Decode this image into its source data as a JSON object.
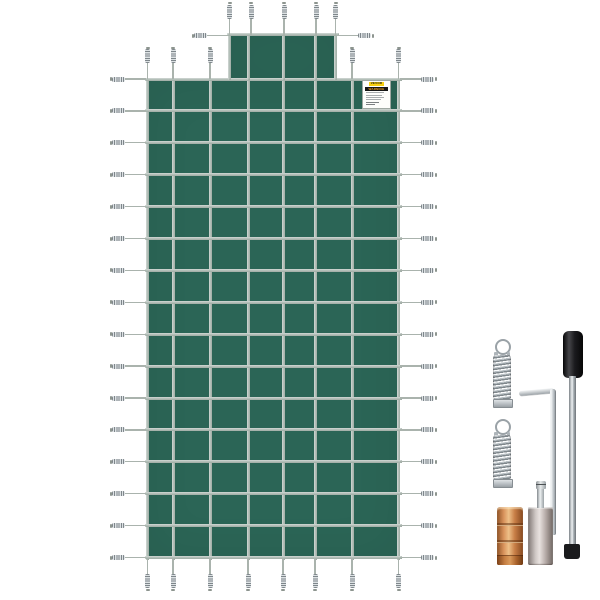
{
  "meta": {
    "description": "Product image: green rectangular inground pool safety cover with center step section, perimeter tension springs and installation hardware kit",
    "background": "#ffffff"
  },
  "colors": {
    "cover_green": "#2b6556",
    "strap": "#b3bfb8",
    "spring_metal": "#9aa1a6",
    "handle_black": "#141416",
    "brass": "#c8824a",
    "nickel": "#c2b6b1",
    "label_yellow": "#f7cf11",
    "warning_bar": "#151515"
  },
  "cover": {
    "grid_columns": 7,
    "grid_rows": 15,
    "step_grid_columns": 3,
    "left_edge_springs": 16,
    "right_edge_springs": 16,
    "top_edge_springs": 5,
    "step_top_springs": 5,
    "step_side_springs": 2,
    "bottom_edge_springs": 8
  },
  "label": {
    "brand": "VEVOR",
    "heading": "WARNING",
    "body_line_count": 6
  },
  "accessories": [
    {
      "name": "tension-spring",
      "count": 2
    },
    {
      "name": "hex-key",
      "count": 1
    },
    {
      "name": "installation-rod",
      "count": 1
    },
    {
      "name": "brass-anchor",
      "count": 1
    },
    {
      "name": "screw-anchor",
      "count": 1
    }
  ]
}
